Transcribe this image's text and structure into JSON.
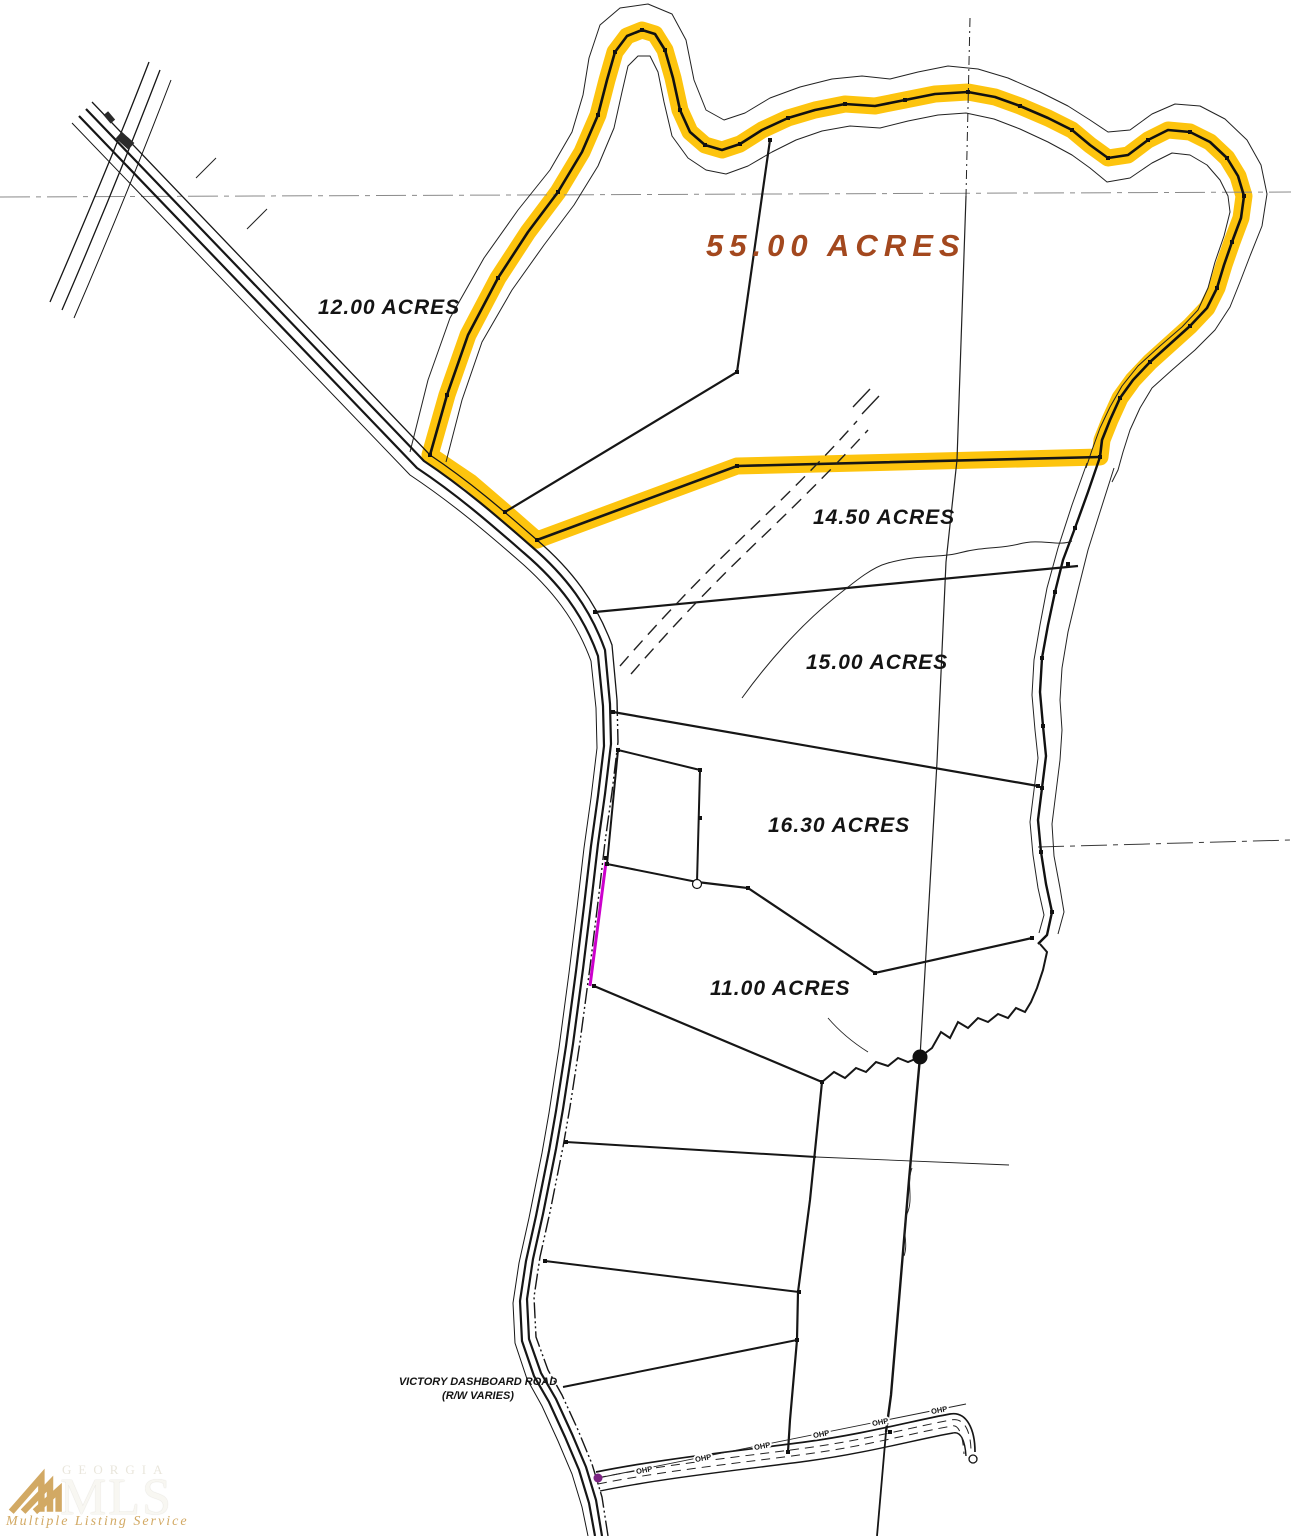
{
  "colors": {
    "highlight": "#fdc40e",
    "accent": "#a3481e",
    "magenta": "#cc00cc",
    "purple": "#7b2382",
    "logo-gold": "#d2a964",
    "line": "#161616"
  },
  "parcels": [
    {
      "id": "parcel-55",
      "label": "55.00 ACRES"
    },
    {
      "id": "parcel-12",
      "label": "12.00 ACRES"
    },
    {
      "id": "parcel-14-5",
      "label": "14.50 ACRES"
    },
    {
      "id": "parcel-15",
      "label": "15.00 ACRES"
    },
    {
      "id": "parcel-16-3",
      "label": "16.30 ACRES"
    },
    {
      "id": "parcel-11",
      "label": "11.00 ACRES"
    }
  ],
  "road": {
    "name_line1": "VICTORY DASHBOARD ROAD",
    "name_line2": "(R/W VARIES)"
  },
  "utility": {
    "ohp_label": "OHP"
  },
  "logo": {
    "region": "GEORGIA",
    "org": "MLS",
    "tagline": "Multiple Listing Service"
  }
}
